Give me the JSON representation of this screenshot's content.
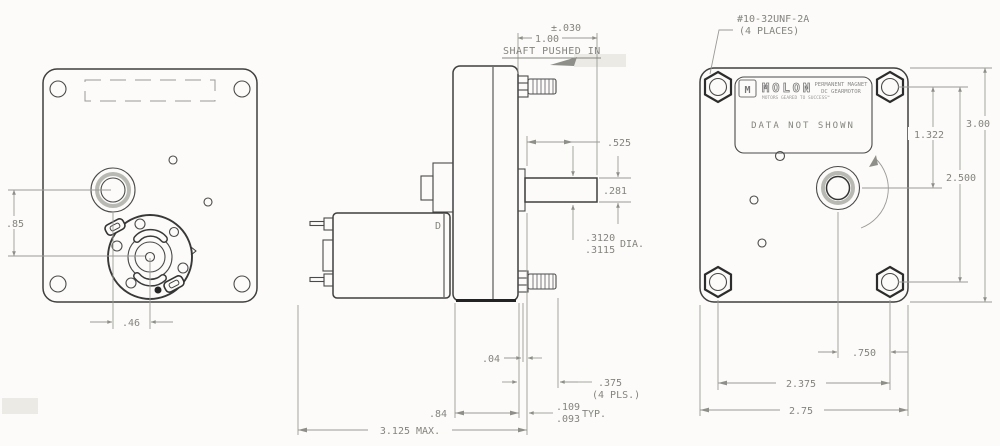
{
  "meta": {
    "drawing_type": "gearmotor-3-view-dimension-drawing",
    "bg_color": "#fcfbf9",
    "object_line_color": "#3f3f3f",
    "dimension_color": "#84847f"
  },
  "front_view": {
    "dims": {
      "center_offset_v": ".85",
      "center_offset_h": ".46"
    }
  },
  "side_view": {
    "labels": {
      "motor_d": "D"
    },
    "dims": {
      "shaft_tol": "±.030",
      "shaft_len": "1.00",
      "shaft_note": "SHAFT PUSHED IN",
      "flat_loc": ".525",
      "flat_height": ".281",
      "dia_hi": ".3120",
      "dia_lo": ".3115",
      "dia_lbl": "DIA.",
      "boss": ".04",
      "stud_len": ".375",
      "stud_note": "(4 PLS.)",
      "plate_hi": ".109",
      "plate_lo": ".093",
      "typ": "TYP.",
      "gearbox_depth": ".84",
      "overall": "3.125 MAX."
    }
  },
  "back_view": {
    "thread": {
      "spec": "#10-32UNF-2A",
      "places": "(4 PLACES)"
    },
    "label": {
      "logo": "M",
      "brand": "MOLON",
      "tagline": "MOTORS GEARED TO SUCCESS™",
      "type1": "PERMANENT MAGNET",
      "type2": "DC GEARMOTOR",
      "note": "DATA NOT SHOWN"
    },
    "dims": {
      "nut_to_shaft": "1.322",
      "plate_height": "3.00",
      "nut_span_v": "2.500",
      "shaft_to_nut": ".750",
      "nut_span_h": "2.375",
      "plate_width": "2.75"
    }
  }
}
